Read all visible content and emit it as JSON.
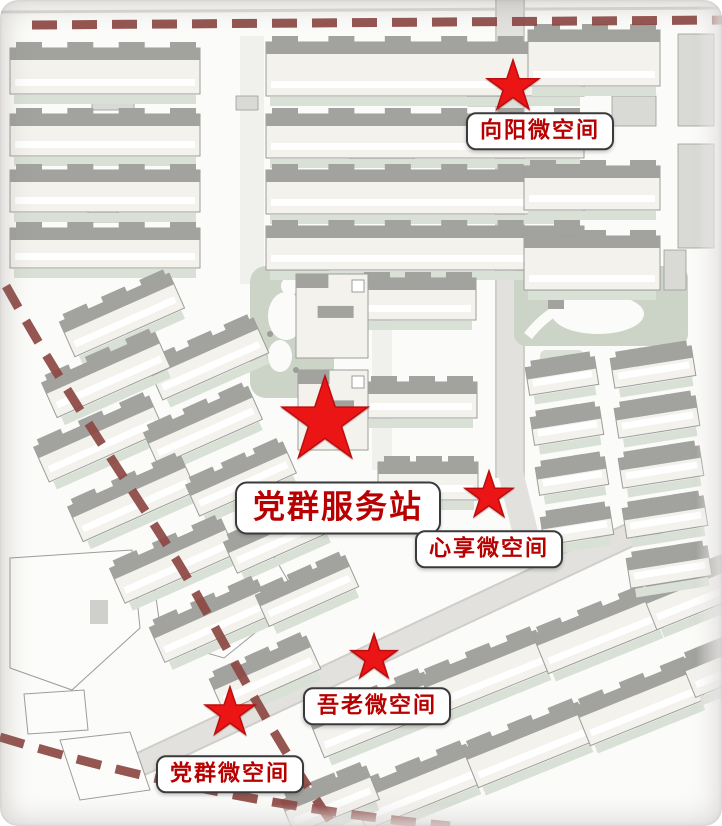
{
  "map": {
    "markers": [
      {
        "label": "党群服务站",
        "kind": "station",
        "star": {
          "x": 325,
          "y": 421,
          "r": 45
        },
        "box": {
          "x": 338,
          "y": 508
        }
      },
      {
        "label": "向阳微空间",
        "kind": "microspace",
        "star": {
          "x": 513,
          "y": 87,
          "r": 27
        },
        "box": {
          "x": 540,
          "y": 131
        }
      },
      {
        "label": "心享微空间",
        "kind": "microspace",
        "star": {
          "x": 489,
          "y": 496,
          "r": 25
        },
        "box": {
          "x": 489,
          "y": 549
        }
      },
      {
        "label": "吾老微空间",
        "kind": "microspace",
        "star": {
          "x": 374,
          "y": 658,
          "r": 24
        },
        "box": {
          "x": 377,
          "y": 706
        }
      },
      {
        "label": "党群微空间",
        "kind": "microspace",
        "star": {
          "x": 230,
          "y": 713,
          "r": 26
        },
        "box": {
          "x": 230,
          "y": 774
        }
      }
    ],
    "colors": {
      "star": "#ec1515",
      "star_edge": "#bb0d0d",
      "label_text": "#b80000",
      "label_border": "#3a3a3a",
      "boundary": "#8c4742",
      "park": "#cbd4c6",
      "roof": "#a2a29f",
      "building": "#f3f2ed",
      "edge": "#9c9c99",
      "sage": "#d9e0d6",
      "road": "#e2e1de",
      "background": "#fbfbf9"
    }
  }
}
